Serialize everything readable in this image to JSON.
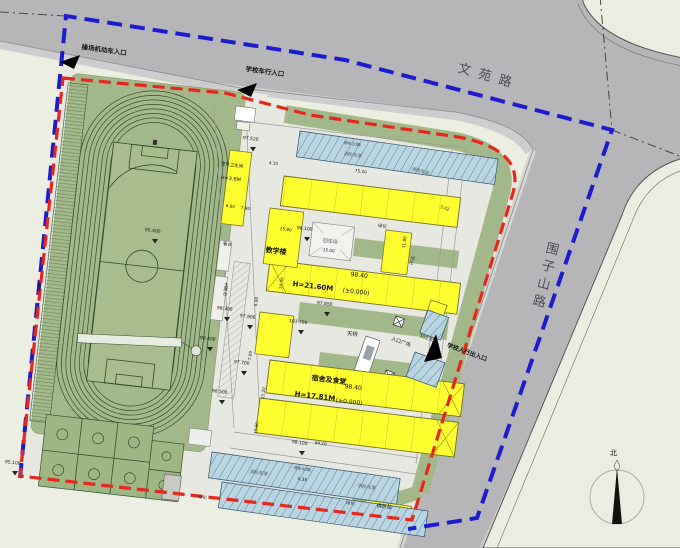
{
  "roads": {
    "top": "文苑路",
    "right": "围子山路"
  },
  "entrances": {
    "playground_vehicle": "操场机动车入口",
    "school_vehicle": "学校车行入口",
    "school_pedestrian": "学校人行出入口"
  },
  "buildings": {
    "teaching": {
      "name": "教学楼",
      "height": "H=21.60M",
      "elevation": "98.40",
      "datum": "(±0.000)"
    },
    "dorm_canteen": {
      "name": "宿舍及食堂",
      "height": "H=17.81M",
      "elevation": "98.40",
      "datum": "(±0.000)"
    },
    "outdoor_toilet": {
      "name": "室外卫生间",
      "height": "H=3.6M"
    },
    "heat_station": {
      "name": "换热站"
    }
  },
  "facilities": {
    "turnaround": "回车场",
    "footbridge": "天桥",
    "entry_plaza": "入口广场",
    "grandstand": "看台",
    "rostrum": "主席台",
    "fire_lane": "消防车道",
    "greenery": "绿化",
    "parking_top": "停车10辆",
    "parking_bottom": "停车40辆"
  },
  "compass": {
    "north": "北"
  },
  "elevations": [
    "97.520",
    "98.300",
    "97.900",
    "98.400",
    "97.700",
    "98.500",
    "98.100",
    "98.100",
    "101.700",
    "102.850",
    "95.100",
    "95.400",
    "97.850"
  ],
  "dims": [
    "75.30",
    "25.80",
    "15.00",
    "11.80",
    "84.20",
    "0.35",
    "6.60",
    "7.80",
    "4.10",
    "14.40",
    "15.20",
    "13.60",
    "7.00",
    "6.90",
    "5.02"
  ],
  "colors": {
    "boundary_red": "#e8261c",
    "boundary_blue": "#1c1ccf",
    "road": "#b6b6b9",
    "green": "#a3b88a",
    "building": "#ffff30",
    "parking": "#b9d5e2"
  }
}
